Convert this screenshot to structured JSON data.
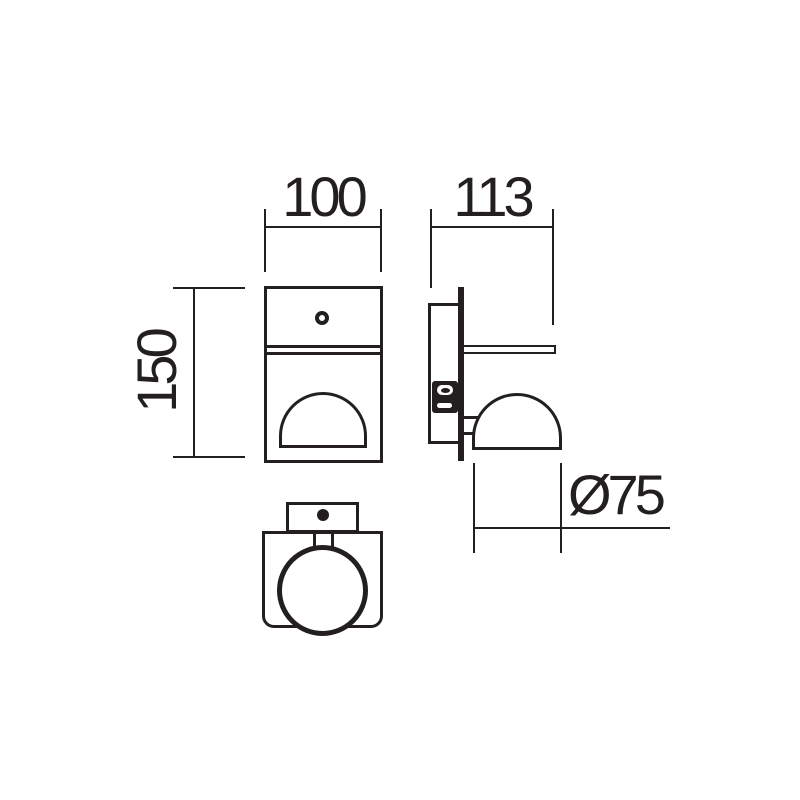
{
  "drawing": {
    "kind": "technical-dimension-drawing",
    "colors": {
      "line": "#231f20",
      "background": "#ffffff"
    },
    "dimensions": {
      "width": "100",
      "depth": "113",
      "height": "150",
      "diameter": "Ø75"
    }
  }
}
